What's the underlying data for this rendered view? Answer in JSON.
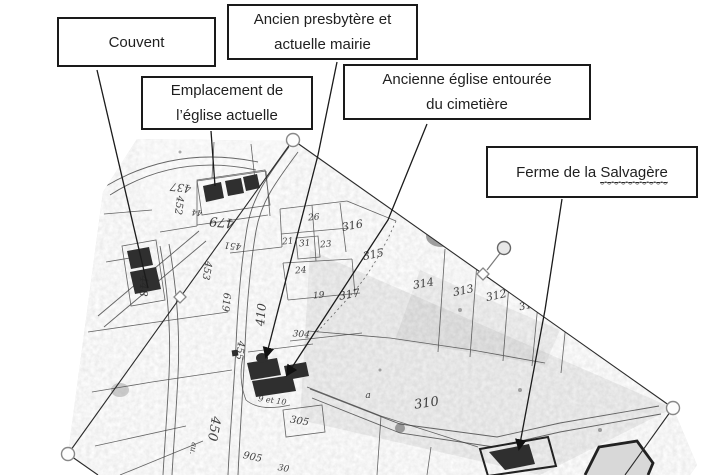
{
  "callouts": {
    "couvent": {
      "label": "Couvent"
    },
    "presbytere": {
      "line1": "Ancien presbytère et",
      "line2": "actuelle mairie"
    },
    "emplacement": {
      "line1": "Emplacement de",
      "line2": "l’église actuelle"
    },
    "ancienne": {
      "line1": "Ancienne église entourée",
      "line2": "du cimetière"
    },
    "ferme": {
      "prefix": "Ferme de la ",
      "underlined": "Salvagère"
    }
  },
  "map": {
    "parcel_labels": [
      {
        "t": "437",
        "x": 181,
        "y": 184,
        "r": 187,
        "s": 11
      },
      {
        "t": "452",
        "x": 176,
        "y": 205,
        "r": 97,
        "s": 10
      },
      {
        "t": "44",
        "x": 197,
        "y": 210,
        "r": 185,
        "s": 8
      },
      {
        "t": "479",
        "x": 222,
        "y": 218,
        "r": 185,
        "s": 13
      },
      {
        "t": "451",
        "x": 233,
        "y": 243,
        "r": 185,
        "s": 9
      },
      {
        "t": "410",
        "x": 265,
        "y": 315,
        "r": 275,
        "s": 12
      },
      {
        "t": "453",
        "x": 204,
        "y": 270,
        "r": 100,
        "s": 10
      },
      {
        "t": "448",
        "x": 140,
        "y": 286,
        "r": 92,
        "s": 11
      },
      {
        "t": "619",
        "x": 223,
        "y": 302,
        "r": 95,
        "s": 10
      },
      {
        "t": "455",
        "x": 237,
        "y": 350,
        "r": 97,
        "s": 10
      },
      {
        "t": "26",
        "x": 314,
        "y": 220,
        "r": -5,
        "s": 9
      },
      {
        "t": "21",
        "x": 288,
        "y": 244,
        "r": -5,
        "s": 9
      },
      {
        "t": "31",
        "x": 305,
        "y": 246,
        "r": -5,
        "s": 9
      },
      {
        "t": "23",
        "x": 326,
        "y": 247,
        "r": -5,
        "s": 9
      },
      {
        "t": "24",
        "x": 301,
        "y": 273,
        "r": -5,
        "s": 9
      },
      {
        "t": "19",
        "x": 319,
        "y": 298,
        "r": -5,
        "s": 9
      },
      {
        "t": "316",
        "x": 353,
        "y": 229,
        "r": -10,
        "s": 11
      },
      {
        "t": "315",
        "x": 374,
        "y": 258,
        "r": -12,
        "s": 11
      },
      {
        "t": "317",
        "x": 350,
        "y": 298,
        "r": -10,
        "s": 11
      },
      {
        "t": "314",
        "x": 424,
        "y": 287,
        "r": -10,
        "s": 11
      },
      {
        "t": "313",
        "x": 464,
        "y": 294,
        "r": -12,
        "s": 11
      },
      {
        "t": "312",
        "x": 497,
        "y": 299,
        "r": -12,
        "s": 11
      },
      {
        "t": "31",
        "x": 526,
        "y": 309,
        "r": -12,
        "s": 10
      },
      {
        "t": "310",
        "x": 427,
        "y": 407,
        "r": -8,
        "s": 13
      },
      {
        "t": "a",
        "x": 368,
        "y": 398,
        "r": 0,
        "s": 9
      },
      {
        "t": "304",
        "x": 301,
        "y": 337,
        "r": 5,
        "s": 9
      },
      {
        "t": "305",
        "x": 299,
        "y": 424,
        "r": 10,
        "s": 10
      },
      {
        "t": "9 et 10",
        "x": 272,
        "y": 403,
        "r": 8,
        "s": 8
      },
      {
        "t": "905",
        "x": 252,
        "y": 460,
        "r": 12,
        "s": 10
      },
      {
        "t": "30",
        "x": 283,
        "y": 471,
        "r": 10,
        "s": 9
      },
      {
        "t": "450",
        "x": 210,
        "y": 428,
        "r": 100,
        "s": 13
      },
      {
        "t": "au.",
        "x": 191,
        "y": 448,
        "r": 100,
        "s": 8
      }
    ]
  },
  "colors": {
    "paper": "#e0e0e0",
    "ink": "#1b1b1b",
    "handle_stroke": "#7a7a7a"
  }
}
